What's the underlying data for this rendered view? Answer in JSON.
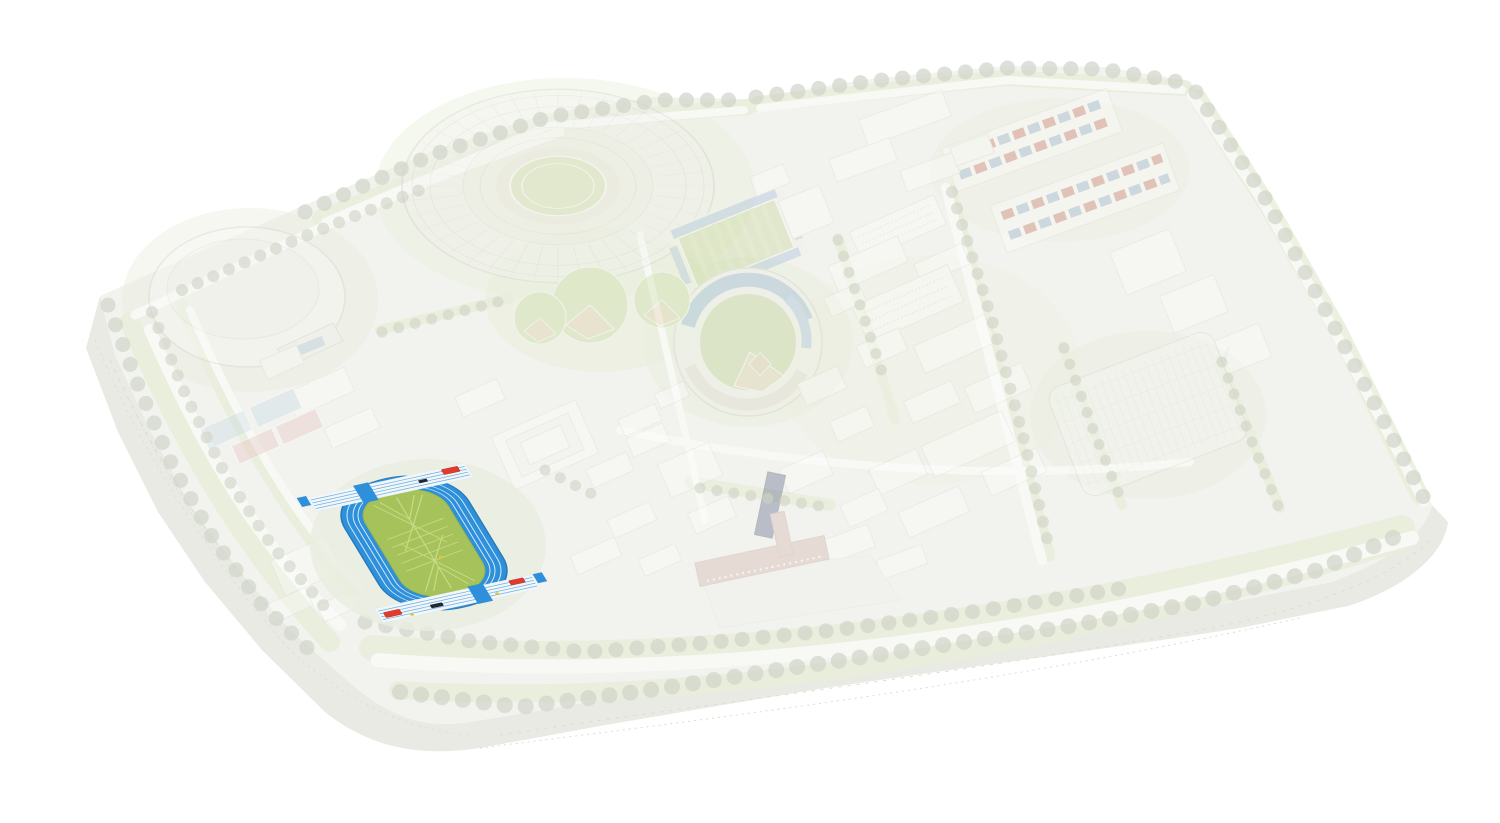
{
  "app": {
    "type": "venue-selection-map",
    "background": "#ffffff"
  },
  "map": {
    "terrain": {
      "surface": "#f2f3ee",
      "cliff": "#e9eae4",
      "cliff_line": "#dcddd5",
      "road": "#f8f9f5",
      "tree": "#d0d4c9",
      "lawn": "#e9eedb"
    },
    "dimmed": {
      "opacity": "0.3"
    },
    "highlighted_venue": {
      "id": "athletics-track",
      "state": "highlighted",
      "track_color": "#2e90da",
      "track_edge": "#2579ba",
      "lane_line": "#d9ecfb",
      "infield": "#a6c25b",
      "infield_edge": "#93b24c",
      "marking": "#c9da86",
      "straight": "#f3f6f8",
      "straight_lane": "#5fade5",
      "mat_red": "#e23b2c",
      "mat_black": "#23272e",
      "dot_yellow": "#e0c83c"
    },
    "venues": [
      {
        "id": "main-oval-stadium",
        "state": "dimmed"
      },
      {
        "id": "dome-arena",
        "state": "dimmed"
      },
      {
        "id": "baseball-stadium",
        "state": "dimmed"
      },
      {
        "id": "practice-ballfields",
        "state": "dimmed"
      },
      {
        "id": "rugby-field",
        "state": "dimmed"
      },
      {
        "id": "residential-blocks",
        "state": "dimmed"
      },
      {
        "id": "lattice-roof-arena",
        "state": "dimmed"
      },
      {
        "id": "tennis-courts",
        "state": "dimmed"
      },
      {
        "id": "reflecting-pool",
        "state": "dimmed"
      },
      {
        "id": "brick-hall-clock-tower",
        "state": "dimmed"
      },
      {
        "id": "athletics-track",
        "state": "highlighted"
      }
    ]
  }
}
